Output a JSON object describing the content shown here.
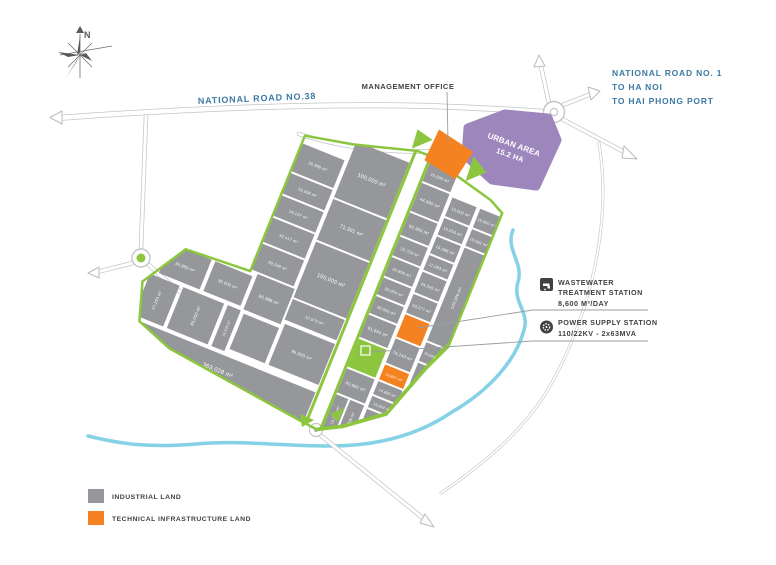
{
  "compass": {
    "north_label": "N"
  },
  "roads": {
    "road38": "NATIONAL ROAD NO.38",
    "road1_line1": "NATIONAL ROAD NO. 1",
    "road1_line2": "TO HA NOI",
    "road1_line3": "TO HAI PHONG PORT"
  },
  "management_office": {
    "label": "MANAGEMENT OFFICE"
  },
  "urban_area": {
    "name": "URBAN AREA",
    "area": "15.2 HA"
  },
  "stations": {
    "wastewater": {
      "line1": "WASTEWATER",
      "line2": "TREATMENT STATION",
      "line3": "8,600 M³/DAY"
    },
    "power": {
      "line1": "POWER SUPPLY STATION",
      "line2": "110/22KV - 2x63MVA"
    }
  },
  "legend": {
    "items": [
      {
        "label": "INDUSTRIAL LAND",
        "color": "#95979a"
      },
      {
        "label": "TECHNICAL INFRASTRUCTURE LAND",
        "color": "#f58220"
      }
    ]
  },
  "plots": [
    "30,996 m²",
    "19,308 m²",
    "19,137 m²",
    "40,417 m²",
    "60,248 m²",
    "100,000 m²",
    "71,391 m²",
    "100,000 m²",
    "10,579 m²",
    "20,000 m²",
    "44,990 m²",
    "50,360 m²",
    "22,754 m²",
    "35,895 m²",
    "33,054 m²",
    "30,500 m²",
    "61,594 m²",
    "80,981 m²",
    "10,225 m²",
    "30,708 m²",
    "15,000 m²",
    "15,053 m²",
    "15,088 m²",
    "11,083 m²",
    "34,505 m²",
    "23,277 m²",
    "76,243 m²",
    "15,847 m²",
    "16,890 m²",
    "15,004 m²",
    "84,571 m²",
    "15,600 m²",
    "15,082 m²",
    "140,026 m²",
    "33,983 m²",
    "30,000 m²",
    "90,388 m²",
    "96,500 m²",
    "67,293 m²",
    "85,000 m²",
    "24,520 m²",
    "363,028 m²",
    "15,064 m²"
  ],
  "colors": {
    "industrial": "#95979a",
    "infrastructure": "#f58220",
    "urban_area": "#9c86bc",
    "green_land": "#8cc63e",
    "river": "#7ed0e6",
    "road_label_blue": "#3c7aa5",
    "text_dark": "#414042"
  }
}
